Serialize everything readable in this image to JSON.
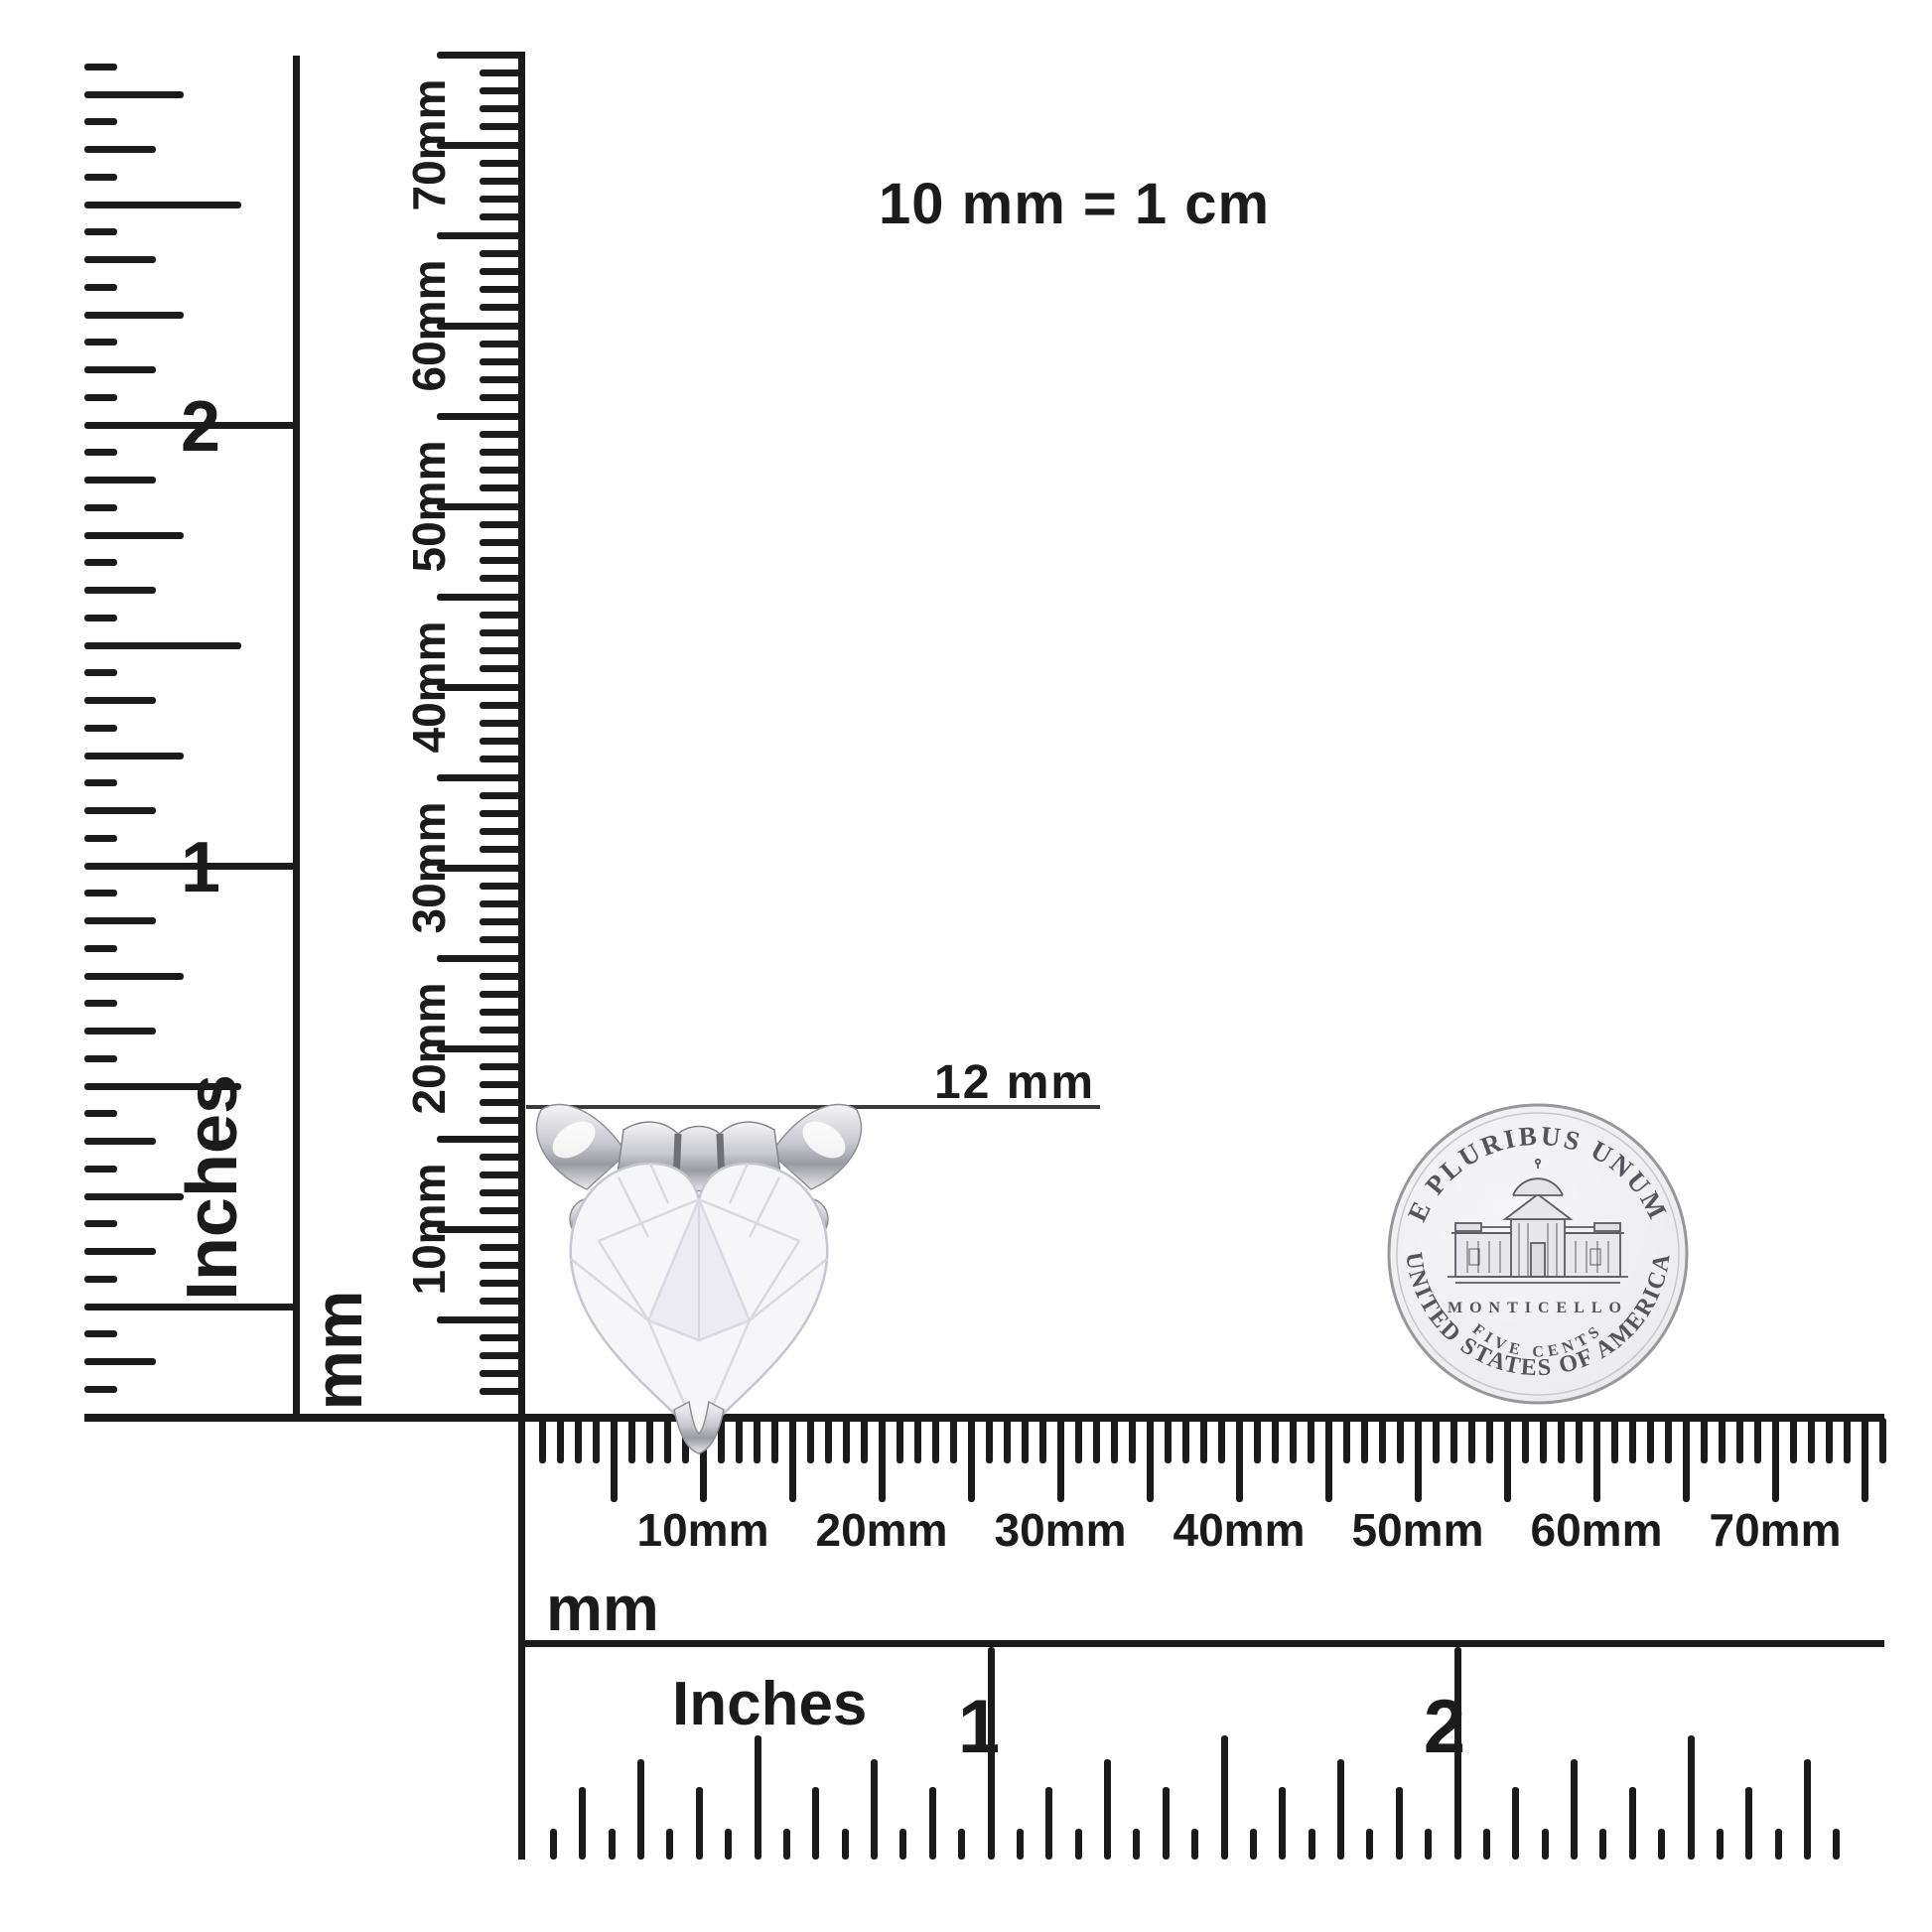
{
  "title": "10 mm = 1 cm",
  "annotation": {
    "label": "12 mm"
  },
  "rulers": {
    "left_inches": {
      "unit": "Inches",
      "numbers": [
        "2",
        "1"
      ]
    },
    "vertical_mm": {
      "unit": "mm",
      "labels": [
        "10mm",
        "20mm",
        "30mm",
        "40mm",
        "50mm",
        "60mm",
        "70mm"
      ]
    },
    "bottom_mm": {
      "unit": "mm",
      "labels": [
        "10mm",
        "20mm",
        "30mm",
        "40mm",
        "50mm",
        "60mm",
        "70mm"
      ]
    },
    "bottom_inches": {
      "unit": "Inches",
      "numbers": [
        "1",
        "2"
      ]
    }
  },
  "pendant": {
    "description": "heart-cut clear stone in prong setting",
    "measured_width": "12 mm"
  },
  "coin": {
    "top_legend": "E PLURIBUS UNUM",
    "building_label": "MONTICELLO",
    "denomination": "FIVE CENTS",
    "bottom_legend": "UNITED STATES OF AMERICA"
  },
  "colors": {
    "ink": "#1b1b1b",
    "annotation_line": "#3a3a3a",
    "coin_silver": "#ededef",
    "coin_rim": "#97979c",
    "coin_text": "#54545a",
    "metal_light": "#f5f5f7",
    "metal_dark": "#9a9aa2",
    "stone_fill": "#f6f6f9",
    "stone_line": "#d9d9e2"
  }
}
